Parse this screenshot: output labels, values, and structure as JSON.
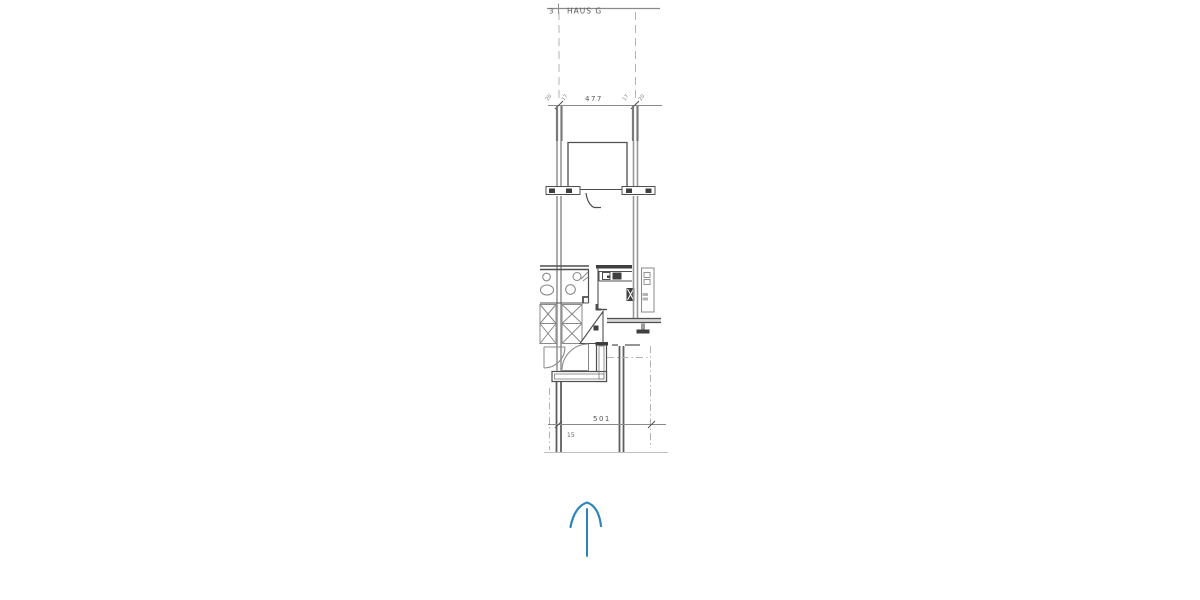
{
  "title_block": {
    "sheet_label": "3",
    "plan_title": "HAUS G"
  },
  "dimensions": {
    "top": {
      "value": "477",
      "post_left_ticks": [
        "20",
        "17"
      ],
      "post_right_ticks": [
        "17",
        "20"
      ]
    },
    "bottom": {
      "value": "501",
      "offset_label": "15"
    }
  },
  "symbols": {
    "north_arrow": "north-arrow-icon",
    "door_swings": "door-swing-arc",
    "wall_hatch": "hatched-wall-block"
  },
  "colors": {
    "paper": "#ffffff",
    "line_dark": "#4f4f4f",
    "wall_gray": "#989898",
    "faint_gray": "#b3b3b3",
    "arrow_blue": "#2b85b8"
  }
}
